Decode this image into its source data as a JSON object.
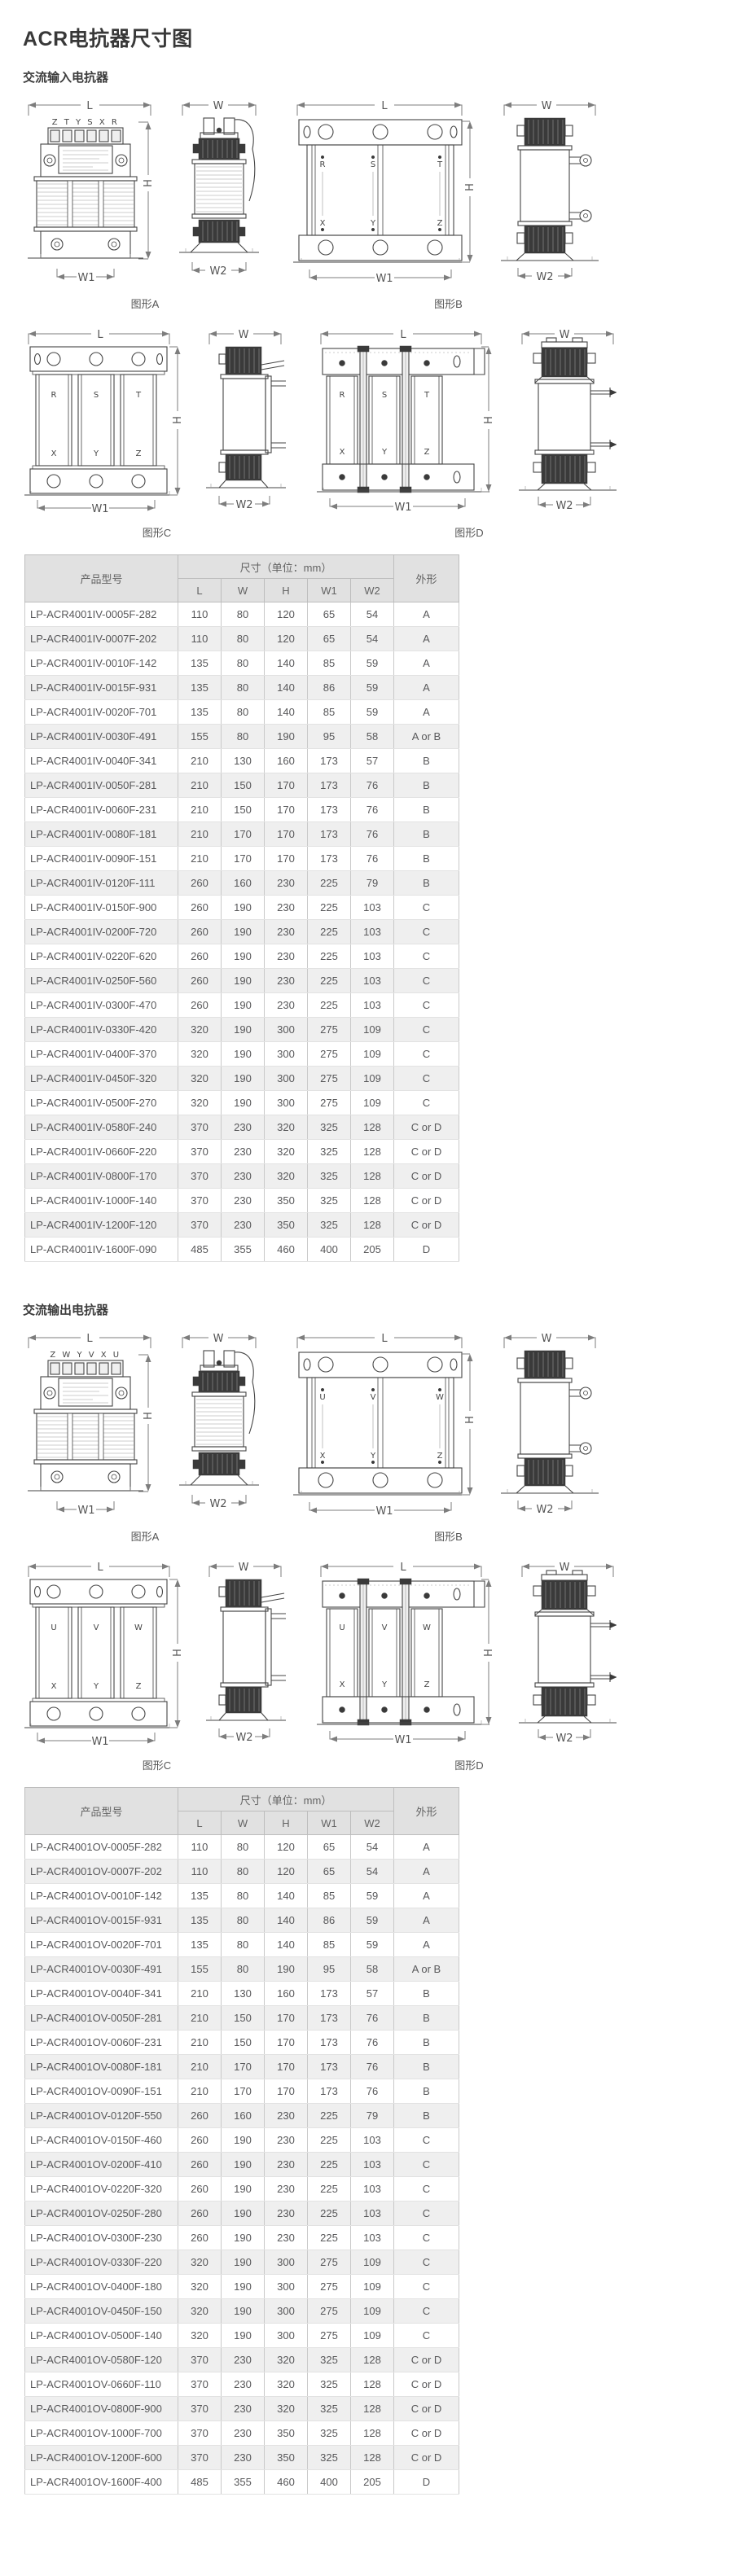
{
  "page": {
    "title": "ACR电抗器尺寸图"
  },
  "colors": {
    "header_bg": "#e1e1e1",
    "row_alt": "#efefef",
    "table_border": "#a9a9a9",
    "text": "#58585a",
    "drawing_line": "#454545"
  },
  "dim_labels": {
    "l": "L",
    "w": "W",
    "h": "H",
    "w1": "W1",
    "w2": "W2"
  },
  "figure_captions": {
    "a": "图形A",
    "b": "图形B",
    "c": "图形C",
    "d": "图形D"
  },
  "table_header": {
    "model": "产品型号",
    "size_group": "尺寸（单位：mm）",
    "cols": [
      "L",
      "W",
      "H",
      "W1",
      "W2"
    ],
    "shape": "外形"
  },
  "sections": [
    {
      "heading": "交流输入电抗器",
      "terminals": {
        "front_a": "Z T Y S X R",
        "top": [
          "R",
          "S",
          "T"
        ],
        "bottom": [
          "X",
          "Y",
          "Z"
        ]
      },
      "table_rows": [
        [
          "LP-ACR4001IV-0005F-282",
          110,
          80,
          120,
          65,
          54,
          "A"
        ],
        [
          "LP-ACR4001IV-0007F-202",
          110,
          80,
          120,
          65,
          54,
          "A"
        ],
        [
          "LP-ACR4001IV-0010F-142",
          135,
          80,
          140,
          85,
          59,
          "A"
        ],
        [
          "LP-ACR4001IV-0015F-931",
          135,
          80,
          140,
          86,
          59,
          "A"
        ],
        [
          "LP-ACR4001IV-0020F-701",
          135,
          80,
          140,
          85,
          59,
          "A"
        ],
        [
          "LP-ACR4001IV-0030F-491",
          155,
          80,
          190,
          95,
          58,
          "A or B"
        ],
        [
          "LP-ACR4001IV-0040F-341",
          210,
          130,
          160,
          173,
          57,
          "B"
        ],
        [
          "LP-ACR4001IV-0050F-281",
          210,
          150,
          170,
          173,
          76,
          "B"
        ],
        [
          "LP-ACR4001IV-0060F-231",
          210,
          150,
          170,
          173,
          76,
          "B"
        ],
        [
          "LP-ACR4001IV-0080F-181",
          210,
          170,
          170,
          173,
          76,
          "B"
        ],
        [
          "LP-ACR4001IV-0090F-151",
          210,
          170,
          170,
          173,
          76,
          "B"
        ],
        [
          "LP-ACR4001IV-0120F-111",
          260,
          160,
          230,
          225,
          79,
          "B"
        ],
        [
          "LP-ACR4001IV-0150F-900",
          260,
          190,
          230,
          225,
          103,
          "C"
        ],
        [
          "LP-ACR4001IV-0200F-720",
          260,
          190,
          230,
          225,
          103,
          "C"
        ],
        [
          "LP-ACR4001IV-0220F-620",
          260,
          190,
          230,
          225,
          103,
          "C"
        ],
        [
          "LP-ACR4001IV-0250F-560",
          260,
          190,
          230,
          225,
          103,
          "C"
        ],
        [
          "LP-ACR4001IV-0300F-470",
          260,
          190,
          230,
          225,
          103,
          "C"
        ],
        [
          "LP-ACR4001IV-0330F-420",
          320,
          190,
          300,
          275,
          109,
          "C"
        ],
        [
          "LP-ACR4001IV-0400F-370",
          320,
          190,
          300,
          275,
          109,
          "C"
        ],
        [
          "LP-ACR4001IV-0450F-320",
          320,
          190,
          300,
          275,
          109,
          "C"
        ],
        [
          "LP-ACR4001IV-0500F-270",
          320,
          190,
          300,
          275,
          109,
          "C"
        ],
        [
          "LP-ACR4001IV-0580F-240",
          370,
          230,
          320,
          325,
          128,
          "C or D"
        ],
        [
          "LP-ACR4001IV-0660F-220",
          370,
          230,
          320,
          325,
          128,
          "C or D"
        ],
        [
          "LP-ACR4001IV-0800F-170",
          370,
          230,
          320,
          325,
          128,
          "C or D"
        ],
        [
          "LP-ACR4001IV-1000F-140",
          370,
          230,
          350,
          325,
          128,
          "C or D"
        ],
        [
          "LP-ACR4001IV-1200F-120",
          370,
          230,
          350,
          325,
          128,
          "C or D"
        ],
        [
          "LP-ACR4001IV-1600F-090",
          485,
          355,
          460,
          400,
          205,
          "D"
        ]
      ]
    },
    {
      "heading": "交流输出电抗器",
      "terminals": {
        "front_a": "Z W Y V X U",
        "top": [
          "U",
          "V",
          "W"
        ],
        "bottom": [
          "X",
          "Y",
          "Z"
        ]
      },
      "table_rows": [
        [
          "LP-ACR4001OV-0005F-282",
          110,
          80,
          120,
          65,
          54,
          "A"
        ],
        [
          "LP-ACR4001OV-0007F-202",
          110,
          80,
          120,
          65,
          54,
          "A"
        ],
        [
          "LP-ACR4001OV-0010F-142",
          135,
          80,
          140,
          85,
          59,
          "A"
        ],
        [
          "LP-ACR4001OV-0015F-931",
          135,
          80,
          140,
          86,
          59,
          "A"
        ],
        [
          "LP-ACR4001OV-0020F-701",
          135,
          80,
          140,
          85,
          59,
          "A"
        ],
        [
          "LP-ACR4001OV-0030F-491",
          155,
          80,
          190,
          95,
          58,
          "A or B"
        ],
        [
          "LP-ACR4001OV-0040F-341",
          210,
          130,
          160,
          173,
          57,
          "B"
        ],
        [
          "LP-ACR4001OV-0050F-281",
          210,
          150,
          170,
          173,
          76,
          "B"
        ],
        [
          "LP-ACR4001OV-0060F-231",
          210,
          150,
          170,
          173,
          76,
          "B"
        ],
        [
          "LP-ACR4001OV-0080F-181",
          210,
          170,
          170,
          173,
          76,
          "B"
        ],
        [
          "LP-ACR4001OV-0090F-151",
          210,
          170,
          170,
          173,
          76,
          "B"
        ],
        [
          "LP-ACR4001OV-0120F-550",
          260,
          160,
          230,
          225,
          79,
          "B"
        ],
        [
          "LP-ACR4001OV-0150F-460",
          260,
          190,
          230,
          225,
          103,
          "C"
        ],
        [
          "LP-ACR4001OV-0200F-410",
          260,
          190,
          230,
          225,
          103,
          "C"
        ],
        [
          "LP-ACR4001OV-0220F-320",
          260,
          190,
          230,
          225,
          103,
          "C"
        ],
        [
          "LP-ACR4001OV-0250F-280",
          260,
          190,
          230,
          225,
          103,
          "C"
        ],
        [
          "LP-ACR4001OV-0300F-230",
          260,
          190,
          230,
          225,
          103,
          "C"
        ],
        [
          "LP-ACR4001OV-0330F-220",
          320,
          190,
          300,
          275,
          109,
          "C"
        ],
        [
          "LP-ACR4001OV-0400F-180",
          320,
          190,
          300,
          275,
          109,
          "C"
        ],
        [
          "LP-ACR4001OV-0450F-150",
          320,
          190,
          300,
          275,
          109,
          "C"
        ],
        [
          "LP-ACR4001OV-0500F-140",
          320,
          190,
          300,
          275,
          109,
          "C"
        ],
        [
          "LP-ACR4001OV-0580F-120",
          370,
          230,
          320,
          325,
          128,
          "C or D"
        ],
        [
          "LP-ACR4001OV-0660F-110",
          370,
          230,
          320,
          325,
          128,
          "C or D"
        ],
        [
          "LP-ACR4001OV-0800F-900",
          370,
          230,
          320,
          325,
          128,
          "C or D"
        ],
        [
          "LP-ACR4001OV-1000F-700",
          370,
          230,
          350,
          325,
          128,
          "C or D"
        ],
        [
          "LP-ACR4001OV-1200F-600",
          370,
          230,
          350,
          325,
          128,
          "C or D"
        ],
        [
          "LP-ACR4001OV-1600F-400",
          485,
          355,
          460,
          400,
          205,
          "D"
        ]
      ]
    }
  ]
}
